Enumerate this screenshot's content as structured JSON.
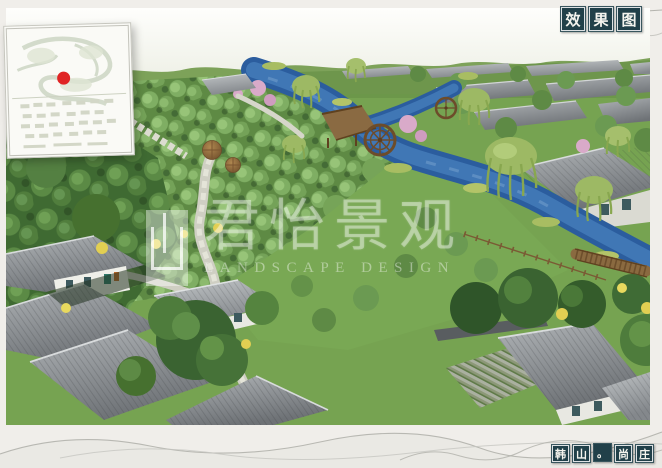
{
  "page": {
    "background": "#f0eeea"
  },
  "title_stamp": {
    "label": "效果图",
    "chars": [
      "效",
      "果",
      "图"
    ],
    "box_color": "#214049",
    "char_color": "#f4f4ee"
  },
  "project_stamp": {
    "label": "韩山·尚庄",
    "chars": [
      "韩",
      "山",
      "尚",
      "庄"
    ],
    "separator": "。",
    "box_color": "#214049"
  },
  "watermark": {
    "cn": "君怡景观",
    "en": "LANDSCAPE DESIGN"
  },
  "inset_map": {
    "marker_color": "#e02424"
  },
  "palette": {
    "river_blue": "#3c74b2",
    "orchard_green": "#86b068",
    "forest_green": "#4e7c3c",
    "grass_green": "#76a351",
    "roof_gray": "#8d9296",
    "wood_brown": "#8a6a40",
    "blossom_pink": "#d8a8c8",
    "shrub_yellow": "#e2cf52",
    "willow_green": "#9db964"
  }
}
